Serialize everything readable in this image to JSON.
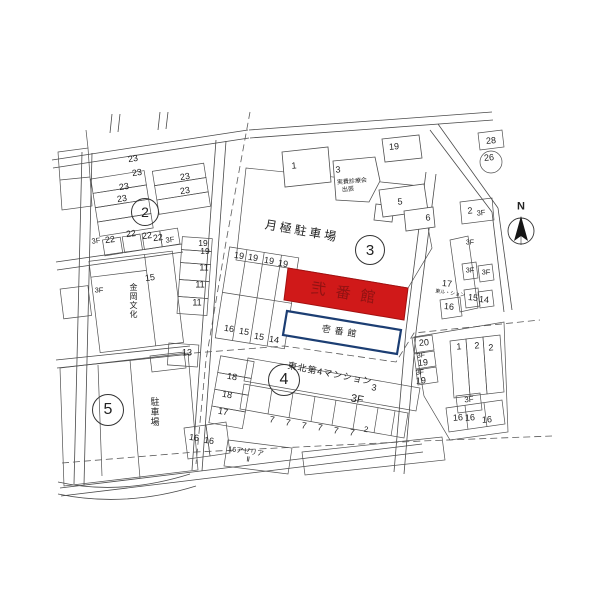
{
  "buildings": {
    "ni_bankan": {
      "name": "弐番館",
      "fill": "#d01919",
      "text_color": "#8f1212"
    },
    "ichi_bankan": {
      "name": "壱番館",
      "border_color": "#1c3e73"
    }
  },
  "compass": {
    "label": "N"
  },
  "blocks": {
    "markers": [
      "2",
      "3",
      "4",
      "5"
    ]
  },
  "map": {
    "labels": [
      {
        "t": "23",
        "x": 133,
        "y": 159,
        "r": -9
      },
      {
        "t": "23",
        "x": 137,
        "y": 173,
        "r": -9
      },
      {
        "t": "23",
        "x": 124,
        "y": 187,
        "r": -9
      },
      {
        "t": "23",
        "x": 122,
        "y": 199,
        "r": -9
      },
      {
        "t": "23",
        "x": 185,
        "y": 177,
        "r": -9
      },
      {
        "t": "23",
        "x": 185,
        "y": 191,
        "r": -9
      },
      {
        "t": "2",
        "x": 145,
        "y": 212,
        "kind": "circ",
        "d": 26,
        "s": 14,
        "n": "block-2-marker"
      },
      {
        "t": "3F",
        "x": 96,
        "y": 241,
        "s": 7.5,
        "r": -7
      },
      {
        "t": "22",
        "x": 110,
        "y": 240,
        "r": -7
      },
      {
        "t": "22",
        "x": 131,
        "y": 234,
        "r": -7
      },
      {
        "t": "22",
        "x": 147,
        "y": 236,
        "r": -7
      },
      {
        "t": "22",
        "x": 158,
        "y": 238,
        "r": -7
      },
      {
        "t": "3F",
        "x": 170,
        "y": 240,
        "s": 7.5,
        "r": -7
      },
      {
        "t": "15",
        "x": 150,
        "y": 278,
        "r": -7
      },
      {
        "t": "金岡文化",
        "x": 133,
        "y": 301,
        "s": 8,
        "kind": "vert",
        "n": "kanaoka-bunka-label"
      },
      {
        "t": "3F",
        "x": 99,
        "y": 290,
        "s": 7.5
      },
      {
        "t": "1",
        "x": 294,
        "y": 166,
        "r": -5
      },
      {
        "t": "3",
        "x": 338,
        "y": 170,
        "r": -5
      },
      {
        "t": "実費診療会",
        "x": 352,
        "y": 182,
        "s": 6,
        "r": -5,
        "n": "small-building-label"
      },
      {
        "t": "出張",
        "x": 348,
        "y": 190,
        "s": 6,
        "r": -5
      },
      {
        "t": "19",
        "x": 394,
        "y": 147,
        "r": -5
      },
      {
        "t": "月極駐車場",
        "x": 302,
        "y": 231,
        "s": 12,
        "r": 10,
        "ls": 3,
        "n": "parking-lot-label"
      },
      {
        "t": "3",
        "x": 370,
        "y": 250,
        "kind": "circ",
        "d": 28,
        "s": 15,
        "n": "block-3-marker"
      },
      {
        "t": "5",
        "x": 400,
        "y": 202,
        "r": -5
      },
      {
        "t": "6",
        "x": 428,
        "y": 218,
        "r": -5
      },
      {
        "t": "28",
        "x": 491,
        "y": 141,
        "r": -5
      },
      {
        "t": "26",
        "x": 489,
        "y": 158,
        "r": -5
      },
      {
        "t": "2",
        "x": 470,
        "y": 211,
        "r": -5
      },
      {
        "t": "3F",
        "x": 481,
        "y": 213,
        "s": 7.5,
        "r": -5
      },
      {
        "t": "N",
        "x": 521,
        "y": 207,
        "s": 11,
        "kind": "bold",
        "n": "compass-n-label"
      },
      {
        "t": "3F",
        "x": 470,
        "y": 243,
        "s": 7
      },
      {
        "t": "3F",
        "x": 470,
        "y": 270,
        "s": 7.5
      },
      {
        "t": "3F",
        "x": 486,
        "y": 272,
        "s": 7.5
      },
      {
        "t": "17",
        "x": 447,
        "y": 284,
        "r": 5
      },
      {
        "t": "東ル・ション",
        "x": 450,
        "y": 294,
        "s": 5,
        "r": 8,
        "n": "building-name-small"
      },
      {
        "t": "15",
        "x": 473,
        "y": 298,
        "r": 5
      },
      {
        "t": "14",
        "x": 484,
        "y": 300,
        "r": 5
      },
      {
        "t": "16",
        "x": 449,
        "y": 307,
        "r": 5
      },
      {
        "t": "19",
        "x": 203,
        "y": 243,
        "s": 8.5
      },
      {
        "t": "19",
        "x": 205,
        "y": 251,
        "s": 8.5
      },
      {
        "t": "11",
        "x": 204,
        "y": 268
      },
      {
        "t": "11",
        "x": 200,
        "y": 285
      },
      {
        "t": "11",
        "x": 197,
        "y": 303
      },
      {
        "t": "13",
        "x": 187,
        "y": 353
      },
      {
        "t": "19",
        "x": 239,
        "y": 256,
        "r": 9
      },
      {
        "t": "19",
        "x": 253,
        "y": 258,
        "r": 9
      },
      {
        "t": "19",
        "x": 269,
        "y": 261,
        "r": 9
      },
      {
        "t": "19",
        "x": 283,
        "y": 264,
        "r": 9
      },
      {
        "t": "16",
        "x": 229,
        "y": 329,
        "r": 9
      },
      {
        "t": "15",
        "x": 244,
        "y": 332,
        "r": 9
      },
      {
        "t": "15",
        "x": 259,
        "y": 337,
        "r": 9
      },
      {
        "t": "14",
        "x": 274,
        "y": 340,
        "r": 9
      },
      {
        "t": "弐番館",
        "x": 348,
        "y": 294,
        "s": 15,
        "r": 9,
        "ls": 10,
        "col": "#8f1212",
        "n": "ni-bankan-label"
      },
      {
        "t": "壱番館",
        "x": 341,
        "y": 332,
        "s": 9,
        "r": 9,
        "ls": 4,
        "n": "ichi-bankan-label"
      },
      {
        "t": "4",
        "x": 284,
        "y": 380,
        "kind": "circ",
        "d": 30,
        "s": 16,
        "n": "block-4-marker"
      },
      {
        "t": "東北第4マンション",
        "x": 330,
        "y": 374,
        "s": 9,
        "r": 11,
        "ls": 1,
        "n": "tohoku-mansion-label"
      },
      {
        "t": "3",
        "x": 374,
        "y": 388,
        "r": 11
      },
      {
        "t": "3F",
        "x": 357,
        "y": 400,
        "s": 11,
        "r": 11
      },
      {
        "t": "18",
        "x": 232,
        "y": 377,
        "r": 10
      },
      {
        "t": "18",
        "x": 227,
        "y": 395,
        "r": 10
      },
      {
        "t": "17",
        "x": 223,
        "y": 412,
        "r": 10
      },
      {
        "t": "7",
        "x": 272,
        "y": 420,
        "r": 11
      },
      {
        "t": "7",
        "x": 288,
        "y": 423,
        "r": 11
      },
      {
        "t": "7",
        "x": 304,
        "y": 426,
        "r": 11
      },
      {
        "t": "7",
        "x": 320,
        "y": 428,
        "r": 11
      },
      {
        "t": "7",
        "x": 336,
        "y": 431,
        "r": 11
      },
      {
        "t": "7",
        "x": 352,
        "y": 433,
        "r": 11
      },
      {
        "t": "2",
        "x": 366,
        "y": 430,
        "s": 8,
        "r": 11
      },
      {
        "t": "16",
        "x": 194,
        "y": 438,
        "r": 8
      },
      {
        "t": "16",
        "x": 209,
        "y": 441,
        "r": 8
      },
      {
        "t": "16アゼリア",
        "x": 246,
        "y": 452,
        "s": 7,
        "r": 8,
        "n": "azalea-label"
      },
      {
        "t": "Ⅱ",
        "x": 248,
        "y": 460,
        "s": 7,
        "r": 8
      },
      {
        "t": "5",
        "x": 108,
        "y": 410,
        "kind": "circ",
        "d": 30,
        "s": 16,
        "n": "block-5-marker"
      },
      {
        "t": "駐車場",
        "x": 154,
        "y": 412,
        "s": 9,
        "kind": "vert",
        "n": "small-parking-label"
      },
      {
        "t": "20",
        "x": 424,
        "y": 343,
        "r": -4
      },
      {
        "t": "3F",
        "x": 421,
        "y": 356,
        "s": 7,
        "r": -4
      },
      {
        "t": "19",
        "x": 423,
        "y": 363,
        "r": -4
      },
      {
        "t": "3F",
        "x": 420,
        "y": 373,
        "s": 7,
        "r": -4
      },
      {
        "t": "19",
        "x": 421,
        "y": 381,
        "r": -4
      },
      {
        "t": "1",
        "x": 459,
        "y": 347,
        "r": -4
      },
      {
        "t": "2",
        "x": 477,
        "y": 346,
        "r": -4
      },
      {
        "t": "2",
        "x": 491,
        "y": 348,
        "r": -4
      },
      {
        "t": "3F",
        "x": 469,
        "y": 400,
        "s": 8,
        "r": -4
      },
      {
        "t": "16",
        "x": 458,
        "y": 418,
        "r": -4
      },
      {
        "t": "16",
        "x": 470,
        "y": 418,
        "r": -4
      },
      {
        "t": "16",
        "x": 487,
        "y": 420,
        "r": -4
      }
    ]
  }
}
